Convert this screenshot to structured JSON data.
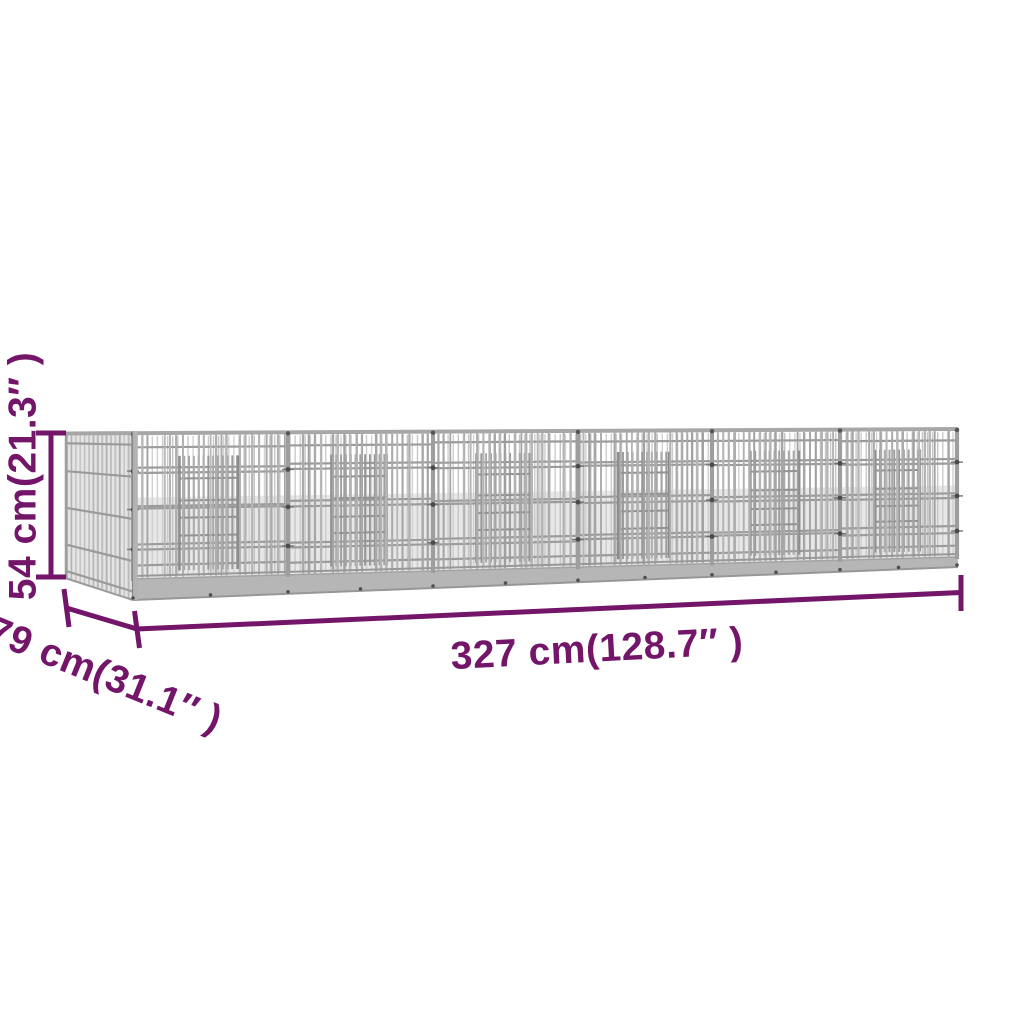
{
  "figure": {
    "subject": "galvanised wire mesh pet cage",
    "dimensions": {
      "height": {
        "value_cm": "54",
        "value_in": "21.3",
        "label": "54 cm(21.3″ )"
      },
      "depth": {
        "value_cm": "79",
        "value_in": "31.1",
        "label": "79 cm(31.1″ )"
      },
      "length": {
        "value_cm": "327",
        "value_in": "128.7",
        "label": "327 cm(128.7″ )"
      }
    }
  },
  "colors": {
    "accent": "#731569",
    "background": "#ffffff",
    "cage_gray": "#b0b0b0",
    "cage_gray_light": "#c9c9c9",
    "cage_gray_dark": "#8f8f8f",
    "connector_dot": "#4a4a4a"
  }
}
